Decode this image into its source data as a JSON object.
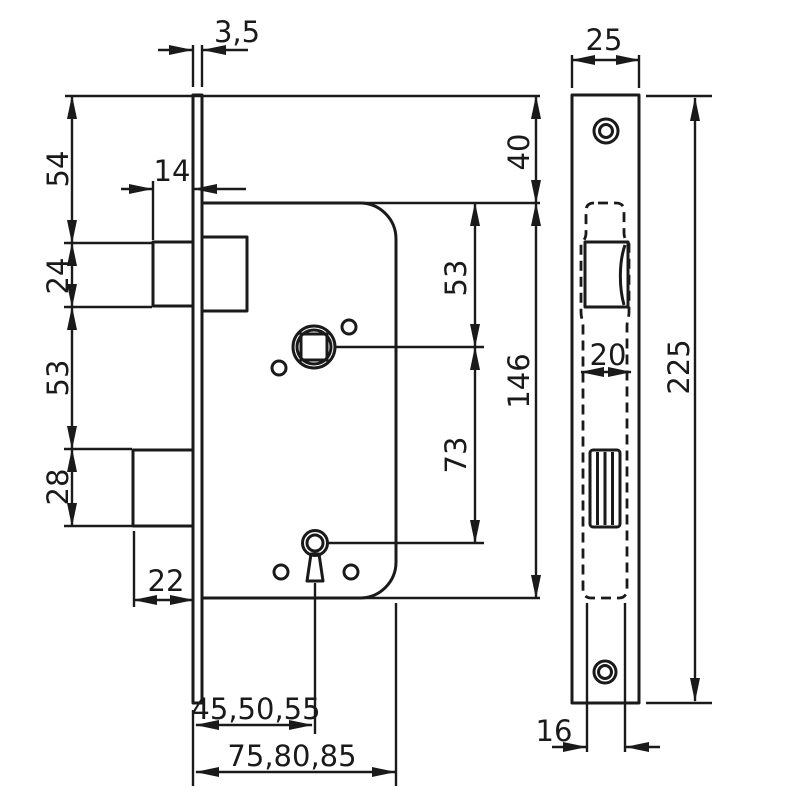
{
  "drawing": {
    "subject": "mortise-lock-technical-drawing",
    "views": {
      "side": "lock case side view",
      "front": "faceplate front view"
    },
    "colors": {
      "line": "#1a1a1a",
      "background": "#ffffff"
    },
    "dims": {
      "plate_thickness": "3,5",
      "top_to_latch": "54",
      "latch_protrusion": "14",
      "latch_height": "24",
      "latch_to_deadbolt": "53",
      "deadbolt_height": "28",
      "deadbolt_protrusion": "22",
      "backset": "45,50,55",
      "case_depth": "75,80,85",
      "plate_top_offset": "40",
      "case_top_to_hub": "53",
      "hub_to_keyhole": "73",
      "case_height": "146",
      "plate_width": "25",
      "pocket_width": "20",
      "plate_height": "225",
      "case_width": "16"
    }
  }
}
